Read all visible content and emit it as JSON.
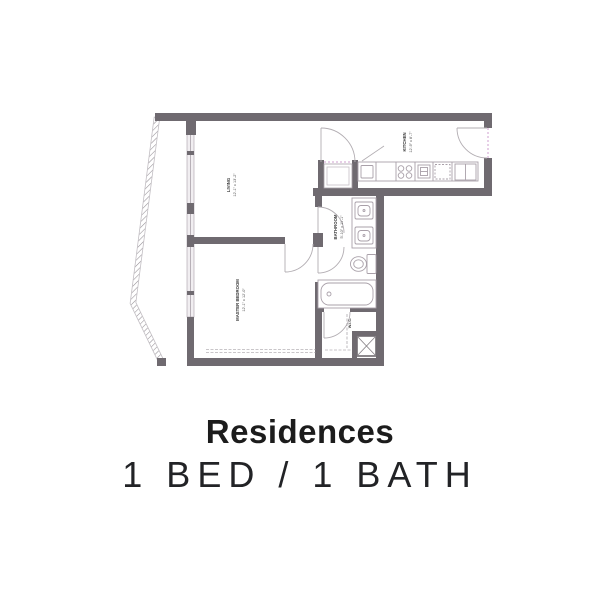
{
  "caption": {
    "title": "Residences",
    "subtitle": "1 BED / 1 BATH"
  },
  "floorplan": {
    "rooms": {
      "living": {
        "name": "LIVING",
        "dims": "12'-1\" x 13'-2\""
      },
      "master_bedroom": {
        "name": "MASTER BEDROOM",
        "dims": "12'-1\" x 12'-0\""
      },
      "bathroom": {
        "name": "BATHROOM",
        "dims": "5'-10\" x 11'-1\""
      },
      "kitchen": {
        "name": "KITCHEN",
        "dims": "12'-9\" x 8'-7\""
      },
      "wic": {
        "name": "W.I.C."
      }
    },
    "colors": {
      "wall": "#6f6a70",
      "fixture_line": "#a9a0a9",
      "opening_dash": "#cf9fcf",
      "title_text": "#1c1c1c"
    }
  }
}
